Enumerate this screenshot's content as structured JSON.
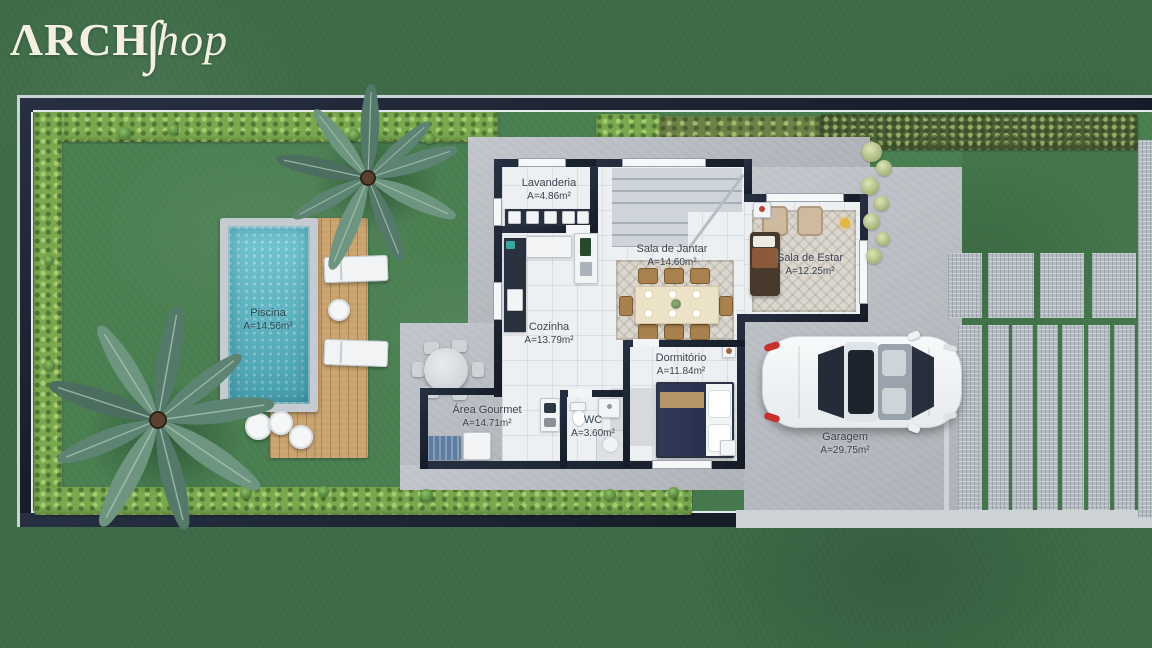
{
  "logo": {
    "part1": "ΛRCH",
    "swash": "∫",
    "part2": "hop"
  },
  "rooms": [
    {
      "id": "lavanderia",
      "name": "Lavanderia",
      "area": "A=4.86m²"
    },
    {
      "id": "sala-de-jantar",
      "name": "Sala de Jantar",
      "area": "A=14.60m²"
    },
    {
      "id": "sala-de-estar",
      "name": "Sala de Estar",
      "area": "A=12.25m²"
    },
    {
      "id": "cozinha",
      "name": "Cozinha",
      "area": "A=13.79m²"
    },
    {
      "id": "dormitorio",
      "name": "Dormitório",
      "area": "A=11.84m²"
    },
    {
      "id": "area-gourmet",
      "name": "Área Gourmet",
      "area": "A=14.71m²"
    },
    {
      "id": "wc",
      "name": "WC",
      "area": "A=3.60m²"
    },
    {
      "id": "garagem",
      "name": "Garagem",
      "area": "A=29.75m²"
    },
    {
      "id": "piscina",
      "name": "Piscina",
      "area": "A=14.56m²"
    }
  ],
  "colors": {
    "outer_grass": "#3f6d49",
    "lawn": "#4a8052",
    "hedge": "#79a84e",
    "hedge_olive": "#4d5f38",
    "wall": "#1d2632",
    "concrete": "#bdc2c8",
    "floor": "#edf0f2",
    "deck_wood": "#c9a26e",
    "pool_water": "#57bac8",
    "car_body": "#f2f4f6",
    "taillight_red": "#c8302e",
    "logo_cream": "#f4f0df"
  }
}
